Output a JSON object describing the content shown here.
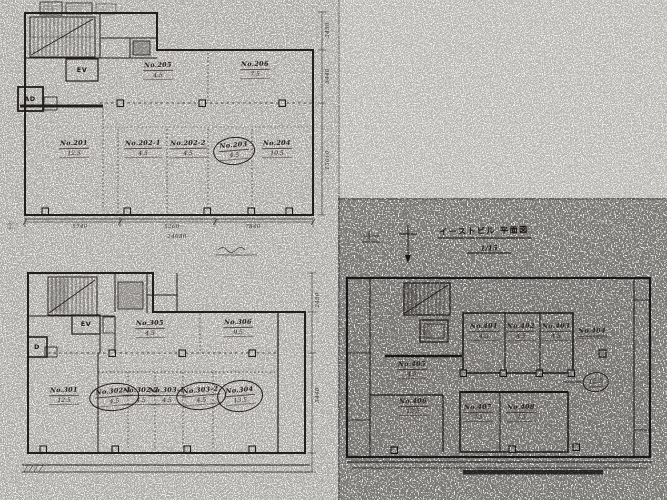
{
  "plan_2f": {
    "elevator_label": "EV",
    "duct_label": "AD",
    "rooms": [
      {
        "no": "No.205",
        "area": "4.5"
      },
      {
        "no": "No.206",
        "area": "7.5"
      },
      {
        "no": "No.201",
        "area": "12.5"
      },
      {
        "no": "No.202-1",
        "area": "4.5"
      },
      {
        "no": "No.202-2",
        "area": "4.5"
      },
      {
        "no": "No.203",
        "area": "4.5"
      },
      {
        "no": "No.204",
        "area": "10.5"
      }
    ],
    "dims_bottom": [
      "5740",
      "5260",
      "7840"
    ],
    "dim_total": "24080",
    "dims_right": [
      "2450",
      "5440",
      "13010"
    ]
  },
  "plan_3f": {
    "elevator_label": "EV",
    "duct_label": "D",
    "rooms": [
      {
        "no": "No.305",
        "area": "4.5"
      },
      {
        "no": "No.306",
        "area": "9.5"
      },
      {
        "no": "No.301",
        "area": "12.5"
      },
      {
        "no": "No.302-1",
        "area": "4.5"
      },
      {
        "no": "No.302-2",
        "area": "4.5"
      },
      {
        "no": "No.303-1",
        "area": "4.5"
      },
      {
        "no": "No.303-2",
        "area": "4.5"
      },
      {
        "no": "No.304",
        "area": "13.5"
      }
    ],
    "dims_right": [
      "2450",
      "5440"
    ]
  },
  "plan_east": {
    "title": "イーストビル 平面図",
    "scale": "1/15",
    "rooms": [
      {
        "no": "No.401",
        "area": "4.5"
      },
      {
        "no": "No.402",
        "area": "4.5"
      },
      {
        "no": "No.403",
        "area": "4.5"
      },
      {
        "no": "No.404",
        "area": ""
      },
      {
        "no": "No.405",
        "area": "4.5"
      },
      {
        "no": "No.406",
        "area": "12.5"
      },
      {
        "no": "No.407",
        "area": "7.5"
      },
      {
        "no": "No.408",
        "area": "7.5"
      }
    ],
    "circle_note": "12.5"
  }
}
